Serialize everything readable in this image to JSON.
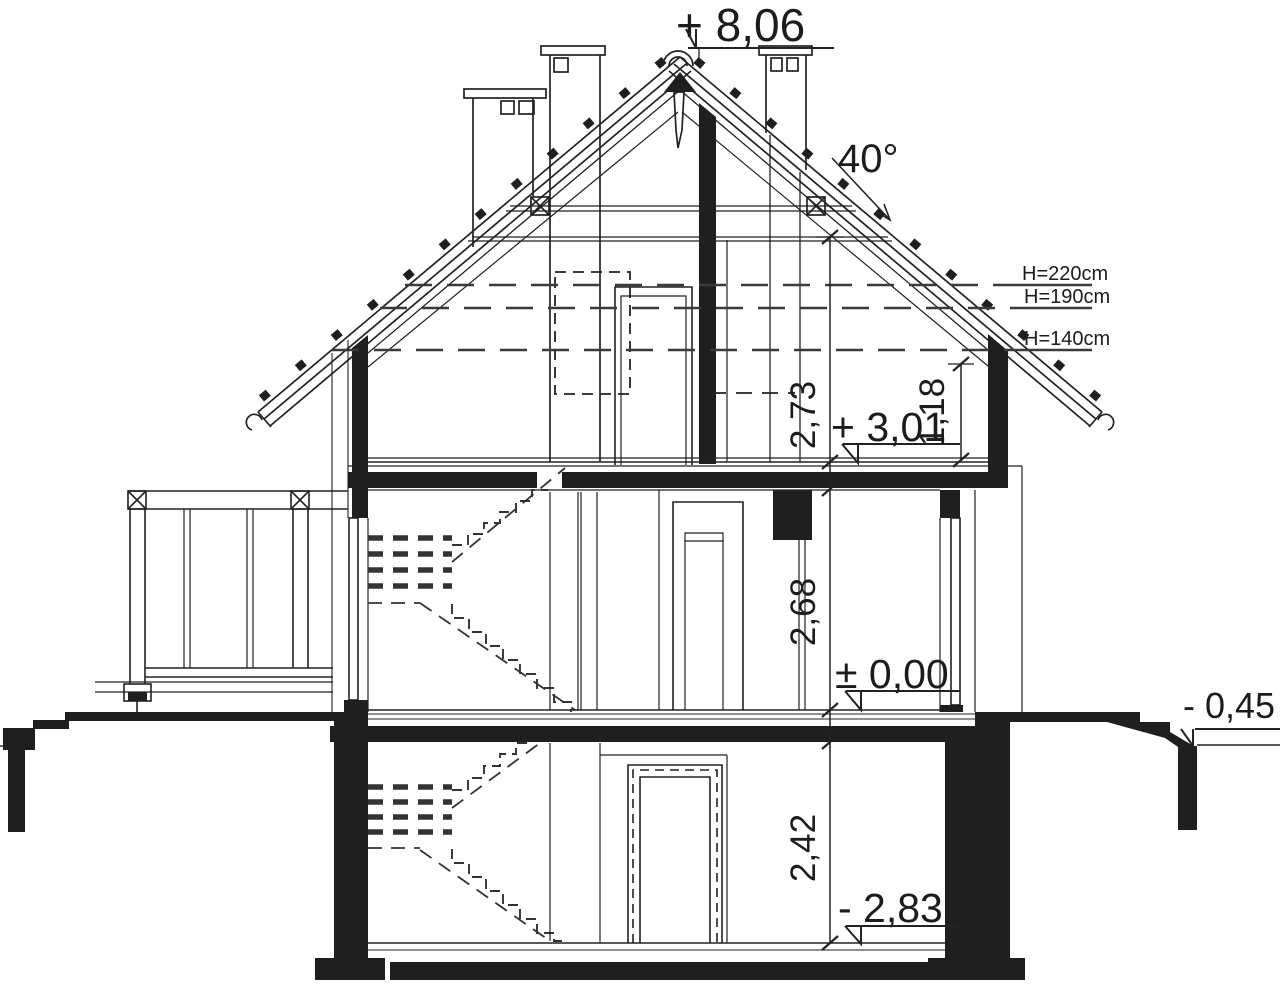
{
  "levels": {
    "ridge": "+ 8,06",
    "attic": "+ 3,01",
    "ground": "± 0,00",
    "terrain": "- 0,45",
    "basement": "- 2,83"
  },
  "dimensions": {
    "attic_room_height": "2,73",
    "knee_wall_height": "1,18",
    "ground_room_height": "2,68",
    "basement_room_height": "2,42"
  },
  "roof": {
    "slope_angle": "40°"
  },
  "headroom_markers": {
    "h220": "H=220cm",
    "h190": "H=190cm",
    "h140": "H=140cm"
  }
}
